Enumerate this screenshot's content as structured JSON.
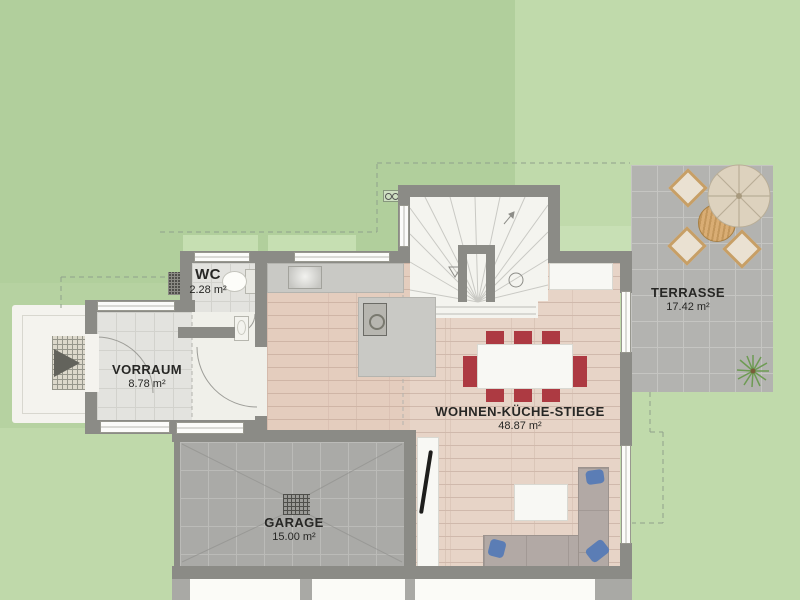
{
  "plan": {
    "rooms": [
      {
        "id": "wc",
        "name": "WC",
        "area": "2.28 m²"
      },
      {
        "id": "vorraum",
        "name": "VORRAUM",
        "area": "8.78 m²"
      },
      {
        "id": "wohnen-kueche-stiege",
        "name": "WOHNEN-KÜCHE-STIEGE",
        "area": "48.87 m²"
      },
      {
        "id": "garage",
        "name": "GARAGE",
        "area": "15.00 m²"
      },
      {
        "id": "terrasse",
        "name": "TERRASSE",
        "area": "17.42 m²"
      }
    ],
    "colors": {
      "lawn": "#B6D2A1",
      "lawn_light": "#C0DAAB",
      "wall": "#8B8B86",
      "wood_floor": "#E7D4C7",
      "tile_floor": "#E3E3DF",
      "terrace_tile": "#B3B3B0",
      "garage_tile": "#AAAAA7",
      "dining_chair": "#AD3A42",
      "sofa": "#B2A9A5",
      "cushion_blue": "#5B7DB5",
      "parasol": "#DDD2BE",
      "wood_table": "#D2A96F",
      "label_text": "#272725"
    }
  }
}
